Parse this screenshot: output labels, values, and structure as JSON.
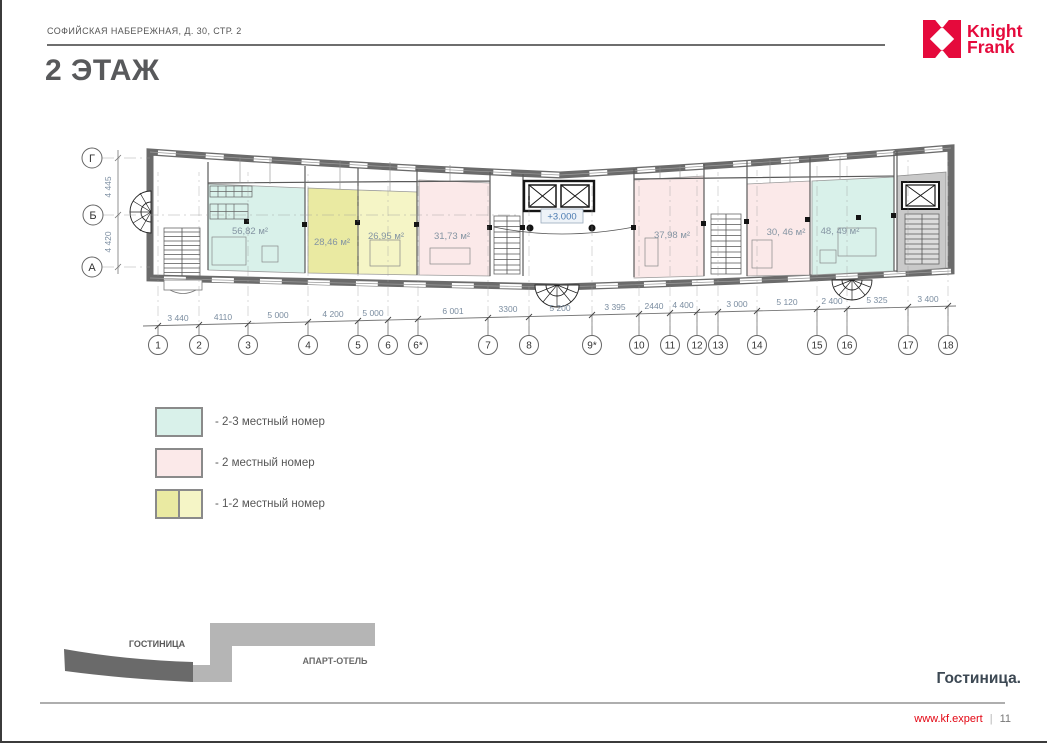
{
  "page": {
    "address_line": "СОФИЙСКАЯ НАБЕРЕЖНАЯ, Д. 30, СТР. 2",
    "title": "2 ЭТАЖ",
    "caption": "Гостиница."
  },
  "logo": {
    "name_line1": "Knight",
    "name_line2": "Frank",
    "brand_color": "#e50a3c"
  },
  "footer": {
    "url": "www.kf.expert",
    "separator": "|",
    "page_number": "11"
  },
  "plan": {
    "elevation_label": "+3.000",
    "row_axes": [
      "Г",
      "Б",
      "А"
    ],
    "vertical_dimensions": [
      "4 445",
      "4 420"
    ],
    "column_axes": [
      "1",
      "2",
      "3",
      "4",
      "5",
      "6",
      "6*",
      "7",
      "8",
      "9*",
      "10",
      "11",
      "12",
      "13",
      "14",
      "15",
      "16",
      "17",
      "18"
    ],
    "dimensions": [
      "3 440",
      "4110",
      "5 000",
      "4 200",
      "5 000",
      "6 001",
      "3300",
      "5 200",
      "3 395",
      "2440",
      "4 400",
      "3 000",
      "5 120",
      "2 400",
      "5 325",
      "3 400"
    ],
    "rooms": [
      {
        "area_label": "56,82 м²",
        "category": "2-3 местный номер",
        "color": "#d9f1ea"
      },
      {
        "area_label": "28,46 м²",
        "category": "1-2 местный номер",
        "color": "#eaeaa2"
      },
      {
        "area_label": "26,95 м²",
        "category": "1-2 местный номер",
        "color": "#f5f5c6"
      },
      {
        "area_label": "31,73 м²",
        "category": "2 местный номер",
        "color": "#fbe9e9"
      },
      {
        "area_label": "37,98 м²",
        "category": "2 местный номер",
        "color": "#fbe9e9"
      },
      {
        "area_label": "30, 46 м²",
        "category": "2 местный номер",
        "color": "#fbe9e9"
      },
      {
        "area_label": "48, 49 м²",
        "category": "2-3 местный номер",
        "color": "#d9f1ea"
      }
    ]
  },
  "legend": {
    "items": [
      {
        "label": "- 2-3 местный номер",
        "colors": [
          "#d9f1ea"
        ]
      },
      {
        "label": "- 2 местный номер",
        "colors": [
          "#fbe9e9"
        ]
      },
      {
        "label": "- 1-2 местный номер",
        "colors": [
          "#eaeaa2",
          "#f5f5c6"
        ]
      }
    ]
  },
  "site_diagram": {
    "hotel_label": "ГОСТИНИЦА",
    "apart_hotel_label": "АПАРТ-ОТЕЛЬ"
  }
}
